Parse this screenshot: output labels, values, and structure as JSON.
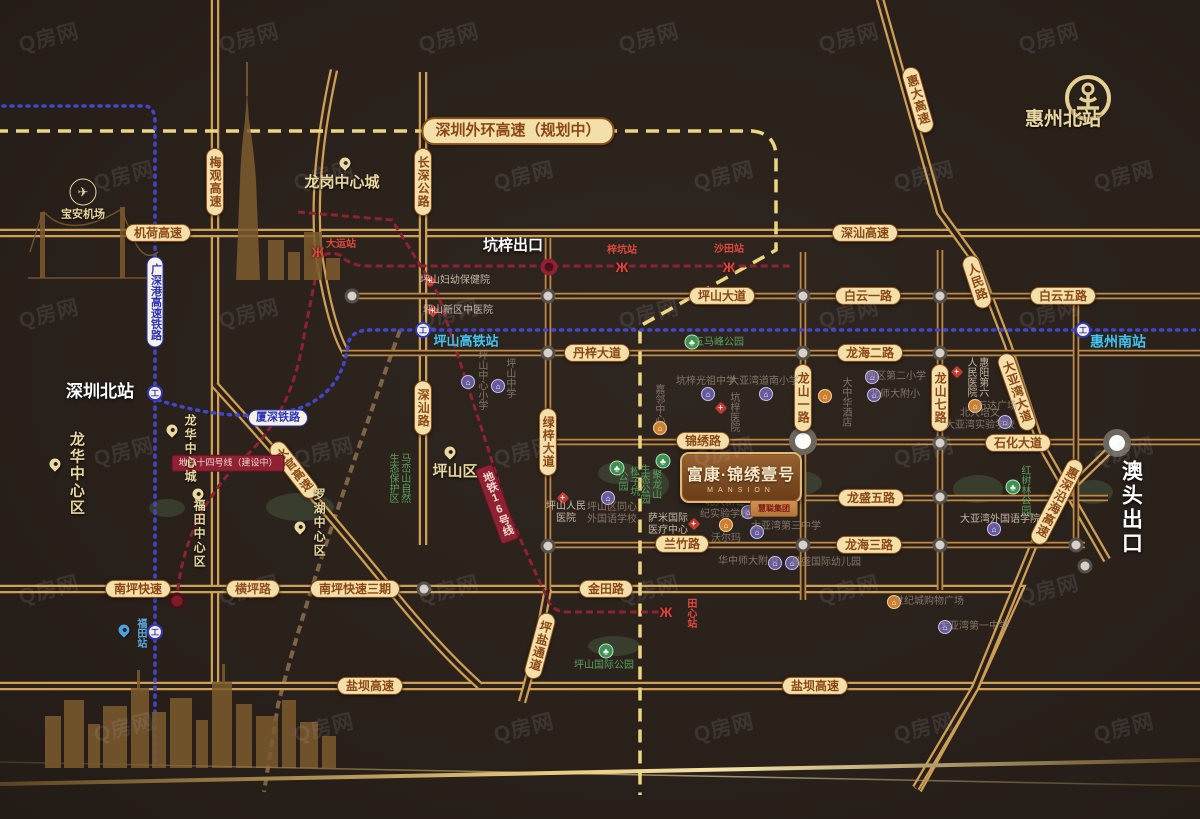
{
  "watermark": {
    "text": "Q房网"
  },
  "project": {
    "name": "富康·锦绣壹号",
    "subtitle": "MANSION",
    "badge": "慧聪集团"
  },
  "colors": {
    "road": "#c08a44",
    "highway": "#cf9f55",
    "planned_dash": "#ecd77f",
    "metro_dash": "#8e2132",
    "rail_dotted": "#4146cc",
    "pill_bg": "#f3dfa9",
    "pill_text": "#8a4715",
    "cyan": "#41c6f3",
    "khaki": "#ead8a0",
    "station_red": "#e0483c",
    "park_green": "#5aa35f",
    "gold": "#e7c87a"
  },
  "map": {
    "texts": [
      {
        "s": "深圳外环高速（规划中）",
        "c": "pill big",
        "x": 518,
        "y": 131,
        "n": "road-label-shenzhen-outer-ring"
      },
      {
        "s": "机荷高速",
        "c": "pill",
        "x": 158,
        "y": 233,
        "n": "road-label-jihe"
      },
      {
        "s": "深汕高速",
        "c": "pill",
        "x": 865,
        "y": 233,
        "n": "road-label-shenshan-expwy"
      },
      {
        "s": "坪山大道",
        "c": "pill",
        "x": 722,
        "y": 296,
        "n": "road-label-pingshan-ave"
      },
      {
        "s": "白云一路",
        "c": "pill",
        "x": 868,
        "y": 296,
        "n": "road-label-baiyun-1"
      },
      {
        "s": "白云五路",
        "c": "pill",
        "x": 1063,
        "y": 296,
        "n": "road-label-baiyun-5"
      },
      {
        "s": "丹梓大道",
        "c": "pill",
        "x": 597,
        "y": 353,
        "n": "road-label-danzi"
      },
      {
        "s": "龙海二路",
        "c": "pill",
        "x": 870,
        "y": 353,
        "n": "road-label-longhai-2"
      },
      {
        "s": "锦绣路",
        "c": "pill",
        "x": 703,
        "y": 441,
        "n": "road-label-jinxiu"
      },
      {
        "s": "石化大道",
        "c": "pill",
        "x": 1018,
        "y": 443,
        "n": "road-label-shihua"
      },
      {
        "s": "龙盛五路",
        "c": "pill",
        "x": 871,
        "y": 498,
        "n": "road-label-longsheng-5"
      },
      {
        "s": "兰竹路",
        "c": "pill",
        "x": 682,
        "y": 544,
        "n": "road-label-lanzhu"
      },
      {
        "s": "龙海三路",
        "c": "pill",
        "x": 869,
        "y": 545,
        "n": "road-label-longhai-3"
      },
      {
        "s": "南坪快速",
        "c": "pill",
        "x": 138,
        "y": 589,
        "n": "road-label-nanping"
      },
      {
        "s": "横坪路",
        "c": "pill",
        "x": 253,
        "y": 589,
        "n": "road-label-hengping"
      },
      {
        "s": "南坪快速三期",
        "c": "pill",
        "x": 355,
        "y": 589,
        "n": "road-label-nanping-3"
      },
      {
        "s": "金田路",
        "c": "pill",
        "x": 606,
        "y": 589,
        "n": "road-label-jintian"
      },
      {
        "s": "盐坝高速",
        "c": "pill",
        "x": 370,
        "y": 686,
        "n": "road-label-yanba-w"
      },
      {
        "s": "盐坝高速",
        "c": "pill",
        "x": 815,
        "y": 686,
        "n": "road-label-yanba-e"
      },
      {
        "s": "长深公路",
        "c": "pill",
        "v": 1,
        "x": 423,
        "y": 182,
        "n": "road-label-changshen"
      },
      {
        "s": "梅观高速",
        "c": "pill",
        "v": 1,
        "x": 215,
        "y": 182,
        "n": "road-label-meiguan"
      },
      {
        "s": "深汕路",
        "c": "pill",
        "v": 1,
        "x": 423,
        "y": 408,
        "n": "road-label-shenshan-rd"
      },
      {
        "s": "绿梓大道",
        "c": "pill",
        "v": 1,
        "x": 548,
        "y": 442,
        "n": "road-label-lvzi"
      },
      {
        "s": "龙山一路",
        "c": "pill",
        "v": 1,
        "x": 803,
        "y": 398,
        "n": "road-label-longshan-1"
      },
      {
        "s": "龙山七路",
        "c": "pill",
        "v": 1,
        "x": 940,
        "y": 398,
        "n": "road-label-longshan-7"
      },
      {
        "s": "水官高速",
        "c": "pill",
        "v": 1,
        "r": -38,
        "x": 294,
        "y": 470,
        "n": "road-label-shuiguan"
      },
      {
        "s": "惠大高速",
        "c": "pill",
        "v": 1,
        "r": -16,
        "x": 918,
        "y": 100,
        "n": "road-label-huida"
      },
      {
        "s": "人民路",
        "c": "pill",
        "v": 1,
        "r": -18,
        "x": 977,
        "y": 282,
        "n": "road-label-renmin"
      },
      {
        "s": "大亚湾大道",
        "c": "pill",
        "v": 1,
        "r": -19,
        "x": 1017,
        "y": 392,
        "n": "road-label-dayawan-ave"
      },
      {
        "s": "惠深沿海高速",
        "c": "pill",
        "v": 1,
        "r": 27,
        "x": 1057,
        "y": 502,
        "n": "road-label-huishen-coastal"
      },
      {
        "s": "坪盐通道",
        "c": "pill",
        "v": 1,
        "r": 15,
        "x": 540,
        "y": 646,
        "n": "road-label-pingyan"
      },
      {
        "s": "广深港高速铁路",
        "c": "railpill",
        "v": 1,
        "x": 155,
        "y": 302,
        "n": "rail-label-guangshengang"
      },
      {
        "s": "厦深铁路",
        "c": "railpill",
        "x": 278,
        "y": 418,
        "n": "rail-label-xiashen"
      },
      {
        "s": "地铁十四号线（建设中）",
        "c": "redbox",
        "x": 228,
        "y": 463,
        "n": "metro-label-line14"
      },
      {
        "s": "地铁16号线",
        "c": "redbox",
        "v": 1,
        "r": -20,
        "x": 497,
        "y": 504,
        "n": "metro-label-line16"
      },
      {
        "s": "深圳北站",
        "c": "white",
        "fs": 17,
        "x": 100,
        "y": 392,
        "n": "station-label-shenzhen-north"
      },
      {
        "s": "坑梓出口",
        "c": "white",
        "x": 513,
        "y": 246,
        "n": "exit-label-kengzi"
      },
      {
        "s": "澳头出口",
        "c": "white",
        "v": 1,
        "fs": 21,
        "x": 1130,
        "y": 508,
        "n": "exit-label-aotou"
      },
      {
        "s": "惠州北站",
        "c": "khaki",
        "fs": 19,
        "x": 1063,
        "y": 120,
        "n": "station-label-huizhou-north"
      },
      {
        "s": "惠州南站",
        "c": "cyan",
        "fs": 14,
        "x": 1118,
        "y": 342,
        "n": "station-label-huizhou-south"
      },
      {
        "s": "坪山高铁站",
        "c": "cyan",
        "x": 466,
        "y": 341,
        "n": "station-label-pingshan-hsr"
      },
      {
        "s": "龙岗中心城",
        "c": "khaki",
        "fs": 15,
        "x": 342,
        "y": 183,
        "n": "area-label-longgang"
      },
      {
        "s": "宝安机场",
        "c": "khaki",
        "fs": 11,
        "x": 83,
        "y": 215,
        "n": "area-label-baoan-airport"
      },
      {
        "s": "坪山区",
        "c": "khaki",
        "fs": 15,
        "x": 455,
        "y": 472,
        "n": "area-label-pingshan"
      },
      {
        "s": "龙华中心区",
        "c": "khaki",
        "v": 1,
        "fs": 15,
        "x": 76,
        "y": 474,
        "n": "area-label-longhua-district"
      },
      {
        "s": "龙华中心城",
        "c": "khaki",
        "v": 1,
        "fs": 12,
        "x": 190,
        "y": 449,
        "n": "area-label-longhua-city"
      },
      {
        "s": "福田中心区",
        "c": "khaki",
        "v": 1,
        "fs": 12,
        "x": 199,
        "y": 534,
        "n": "area-label-futian"
      },
      {
        "s": "罗湖中心区",
        "c": "khaki",
        "v": 1,
        "fs": 12,
        "x": 319,
        "y": 523,
        "n": "area-label-luohu"
      },
      {
        "s": "大运站",
        "c": "sta",
        "x": 341,
        "y": 245,
        "n": "metro-station-dayun"
      },
      {
        "s": "梓坑站",
        "c": "sta",
        "x": 622,
        "y": 251,
        "n": "metro-station-zikeng"
      },
      {
        "s": "沙田站",
        "c": "sta",
        "x": 729,
        "y": 250,
        "n": "metro-station-shatian"
      },
      {
        "s": "田心站",
        "c": "sta",
        "v": 1,
        "x": 690,
        "y": 613,
        "n": "metro-station-tianxin"
      },
      {
        "s": "福田站",
        "c": "bluesta",
        "v": 1,
        "x": 140,
        "y": 633,
        "n": "station-label-futian-hsr"
      },
      {
        "s": "五马峰公园",
        "c": "park",
        "x": 719,
        "y": 343,
        "n": "park-wumafeng"
      },
      {
        "s": "坪山国际公园",
        "c": "park",
        "x": 604,
        "y": 666,
        "n": "park-pingshan-intl"
      },
      {
        "ls": [
          "松子坑",
          "公园"
        ],
        "c": "park",
        "v": 1,
        "x": 627,
        "y": 481,
        "n": "park-songzikeng"
      },
      {
        "ls": [
          "聚龙山",
          "生态公园"
        ],
        "c": "park",
        "v": 1,
        "x": 649,
        "y": 484,
        "n": "park-julongshan"
      },
      {
        "s": "红树林公园",
        "c": "park",
        "v": 1,
        "x": 1024,
        "y": 490,
        "n": "park-hongshulin"
      },
      {
        "ls": [
          "马峦山自然",
          "生态保护区"
        ],
        "c": "park",
        "v": 1,
        "x": 398,
        "y": 478,
        "n": "park-maluanshan"
      },
      {
        "s": "坪山妇幼保健院",
        "c": "poi",
        "x": 455,
        "y": 281,
        "n": "poi-fuyou-hospital"
      },
      {
        "s": "坪山新区中医院",
        "c": "poi",
        "x": 458,
        "y": 311,
        "n": "poi-zhongyi-hospital"
      },
      {
        "ls": [
          "坪山人民",
          "医院"
        ],
        "c": "poi",
        "x": 566,
        "y": 513,
        "n": "poi-renmin-hospital"
      },
      {
        "ls": [
          "萨米国际",
          "医疗中心"
        ],
        "c": "poi",
        "x": 668,
        "y": 525,
        "n": "poi-sami-medical"
      },
      {
        "s": "大亚湾外国语学院",
        "c": "poi",
        "x": 1000,
        "y": 520,
        "n": "poi-dayawan-foreign-college"
      },
      {
        "ls": [
          "惠阳第六",
          "人民医院"
        ],
        "c": "poi",
        "v": 1,
        "x": 976,
        "y": 377,
        "n": "poi-huiyang-6th-hospital"
      },
      {
        "s": "坑梓医院",
        "c": "poi dim",
        "v": 1,
        "x": 733,
        "y": 412,
        "n": "poi-kengzi-hospital"
      },
      {
        "s": "大中华酒店",
        "c": "poi dim",
        "v": 1,
        "x": 845,
        "y": 402,
        "n": "poi-dazhonghua-hotel"
      },
      {
        "s": "嘉邻中心",
        "c": "poi dim",
        "v": 1,
        "x": 658,
        "y": 404,
        "n": "poi-jialin-center"
      },
      {
        "s": "坪山中心小学",
        "c": "poi dim",
        "v": 1,
        "x": 481,
        "y": 380,
        "n": "poi-pingshan-central-primary"
      },
      {
        "s": "坪山中学",
        "c": "poi dim",
        "v": 1,
        "x": 509,
        "y": 378,
        "n": "poi-pingshan-middle"
      },
      {
        "ls": [
          "坪山区同心",
          "外国语学校"
        ],
        "c": "poi dim",
        "x": 612,
        "y": 514,
        "n": "poi-tongxin-foreign-school"
      },
      {
        "s": "坑梓光祖中学",
        "c": "poi dim",
        "x": 706,
        "y": 382,
        "n": "poi-guangzu-middle"
      },
      {
        "s": "大亚湾道南小学",
        "c": "poi dim",
        "x": 764,
        "y": 382,
        "n": "poi-daonan-primary"
      },
      {
        "s": "西区第二小学",
        "c": "poi dim",
        "x": 896,
        "y": 377,
        "n": "poi-xiqu-2nd-primary"
      },
      {
        "s": "北师大附小",
        "c": "poi dim",
        "x": 895,
        "y": 395,
        "n": "poi-bnu-primary"
      },
      {
        "ls": [
          "北大新世",
          "纪实验学校"
        ],
        "c": "poi dim",
        "x": 725,
        "y": 509,
        "n": "poi-beida-xinshiji-school"
      },
      {
        "ls": [
          "北大培文",
          "大亚湾实验学校"
        ],
        "c": "poi dim",
        "x": 980,
        "y": 420,
        "n": "poi-beida-peiwen-school"
      },
      {
        "s": "沃尔玛",
        "c": "poi dim",
        "x": 726,
        "y": 539,
        "n": "poi-walmart"
      },
      {
        "s": "万达广场",
        "c": "poi dim",
        "x": 997,
        "y": 407,
        "n": "poi-wanda-plaza"
      },
      {
        "s": "世纪城购物广场",
        "c": "poi dim",
        "x": 929,
        "y": 602,
        "n": "poi-shijicheng-mall"
      },
      {
        "s": "大亚湾第三中学",
        "c": "poi dim",
        "x": 786,
        "y": 527,
        "n": "poi-dayawan-3rd-middle"
      },
      {
        "s": "华中师大附小",
        "c": "poi dim",
        "x": 748,
        "y": 562,
        "n": "poi-huazhongshida-primary"
      },
      {
        "s": "昌盛国际幼儿园",
        "c": "poi dim",
        "x": 826,
        "y": 563,
        "n": "poi-changsheng-kindergarten"
      },
      {
        "s": "大亚湾第一中学",
        "c": "poi dim",
        "x": 974,
        "y": 627,
        "n": "poi-dayawan-1st-middle"
      }
    ],
    "icons": [
      {
        "k": "rail",
        "x": 155,
        "y": 393,
        "n": "shenzhen-north-rail-icon"
      },
      {
        "k": "rail",
        "x": 155,
        "y": 632,
        "n": "futian-rail-icon"
      },
      {
        "k": "rail",
        "x": 423,
        "y": 330,
        "n": "pingshan-hsr-rail-icon"
      },
      {
        "k": "rail",
        "x": 1083,
        "y": 330,
        "n": "huizhou-south-rail-icon"
      },
      {
        "k": "plane",
        "x": 83,
        "y": 192,
        "n": "airport-icon"
      },
      {
        "k": "pin",
        "x": 345,
        "y": 163,
        "n": "longgang-pin-icon"
      },
      {
        "k": "pin",
        "x": 55,
        "y": 464,
        "n": "longhua-district-pin-icon"
      },
      {
        "k": "pin",
        "x": 172,
        "y": 430,
        "n": "longhua-city-pin-icon"
      },
      {
        "k": "pin",
        "x": 198,
        "y": 494,
        "n": "futian-pin-icon"
      },
      {
        "k": "pin",
        "x": 300,
        "y": 527,
        "n": "luohu-pin-icon"
      },
      {
        "k": "pin",
        "x": 450,
        "y": 452,
        "n": "pingshan-pin-icon"
      },
      {
        "k": "pinblue",
        "x": 124,
        "y": 630,
        "n": "futian-station-pin-icon"
      },
      {
        "k": "metro",
        "x": 318,
        "y": 252,
        "n": "dayun-metro-icon"
      },
      {
        "k": "metro",
        "x": 622,
        "y": 267,
        "n": "zikeng-metro-icon"
      },
      {
        "k": "metro",
        "x": 729,
        "y": 267,
        "n": "shatian-metro-icon"
      },
      {
        "k": "metro",
        "x": 666,
        "y": 612,
        "n": "tianxin-metro-icon"
      },
      {
        "k": "exit",
        "x": 549,
        "y": 267,
        "n": "kengzi-exit-icon"
      },
      {
        "k": "sta14",
        "x": 177,
        "y": 601,
        "n": "line14-station-icon"
      },
      {
        "k": "hospital",
        "x": 430,
        "y": 281,
        "n": "hospital-icon"
      },
      {
        "k": "hospital",
        "x": 433,
        "y": 311,
        "n": "hospital-icon"
      },
      {
        "k": "hospital",
        "x": 563,
        "y": 498,
        "n": "hospital-icon"
      },
      {
        "k": "hospital",
        "x": 721,
        "y": 408,
        "n": "hospital-icon"
      },
      {
        "k": "hospital",
        "x": 694,
        "y": 524,
        "n": "hospital-icon"
      },
      {
        "k": "hospital",
        "x": 957,
        "y": 372,
        "n": "hospital-icon"
      },
      {
        "k": "school",
        "x": 468,
        "y": 382,
        "n": "school-icon"
      },
      {
        "k": "school",
        "x": 498,
        "y": 386,
        "n": "school-icon"
      },
      {
        "k": "school",
        "x": 608,
        "y": 498,
        "n": "school-icon"
      },
      {
        "k": "school",
        "x": 708,
        "y": 394,
        "n": "school-icon"
      },
      {
        "k": "school",
        "x": 766,
        "y": 394,
        "n": "school-icon"
      },
      {
        "k": "school",
        "x": 872,
        "y": 377,
        "n": "school-icon"
      },
      {
        "k": "school",
        "x": 874,
        "y": 395,
        "n": "school-icon"
      },
      {
        "k": "school",
        "x": 748,
        "y": 512,
        "n": "school-icon"
      },
      {
        "k": "school",
        "x": 757,
        "y": 532,
        "n": "school-icon"
      },
      {
        "k": "school",
        "x": 775,
        "y": 563,
        "n": "school-icon"
      },
      {
        "k": "school",
        "x": 792,
        "y": 563,
        "n": "school-icon"
      },
      {
        "k": "school",
        "x": 945,
        "y": 627,
        "n": "school-icon"
      },
      {
        "k": "school",
        "x": 994,
        "y": 529,
        "n": "school-icon"
      },
      {
        "k": "school",
        "x": 1005,
        "y": 422,
        "n": "school-icon"
      },
      {
        "k": "mall",
        "x": 726,
        "y": 525,
        "n": "mall-icon"
      },
      {
        "k": "mall",
        "x": 975,
        "y": 406,
        "n": "mall-icon"
      },
      {
        "k": "mall",
        "x": 894,
        "y": 602,
        "n": "mall-icon"
      },
      {
        "k": "mall",
        "x": 660,
        "y": 428,
        "n": "mall-icon"
      },
      {
        "k": "hotel",
        "x": 825,
        "y": 396,
        "n": "hotel-icon"
      },
      {
        "k": "park",
        "x": 692,
        "y": 342,
        "n": "park-icon"
      },
      {
        "k": "park",
        "x": 617,
        "y": 468,
        "n": "park-icon"
      },
      {
        "k": "park",
        "x": 663,
        "y": 461,
        "n": "park-icon"
      },
      {
        "k": "park",
        "x": 606,
        "y": 651,
        "n": "park-icon"
      },
      {
        "k": "park",
        "x": 1013,
        "y": 487,
        "n": "park-icon"
      },
      {
        "k": "dot",
        "x": 352,
        "y": 296,
        "n": "junction-dot"
      },
      {
        "k": "dot",
        "x": 548,
        "y": 296,
        "n": "junction-dot"
      },
      {
        "k": "dot",
        "x": 548,
        "y": 353,
        "n": "junction-dot"
      },
      {
        "k": "dot",
        "x": 548,
        "y": 443,
        "n": "junction-dot"
      },
      {
        "k": "dot",
        "x": 548,
        "y": 546,
        "n": "junction-dot"
      },
      {
        "k": "dot",
        "x": 424,
        "y": 589,
        "n": "junction-dot"
      },
      {
        "k": "dot",
        "x": 803,
        "y": 296,
        "n": "junction-dot"
      },
      {
        "k": "dot",
        "x": 803,
        "y": 353,
        "n": "junction-dot"
      },
      {
        "k": "dot",
        "x": 803,
        "y": 545,
        "n": "junction-dot"
      },
      {
        "k": "dot",
        "x": 940,
        "y": 296,
        "n": "junction-dot"
      },
      {
        "k": "dot",
        "x": 940,
        "y": 353,
        "n": "junction-dot"
      },
      {
        "k": "dot",
        "x": 940,
        "y": 443,
        "n": "junction-dot"
      },
      {
        "k": "dot",
        "x": 940,
        "y": 497,
        "n": "junction-dot"
      },
      {
        "k": "dot",
        "x": 940,
        "y": 545,
        "n": "junction-dot"
      },
      {
        "k": "dot",
        "x": 1076,
        "y": 296,
        "n": "junction-dot"
      },
      {
        "k": "dot",
        "x": 1076,
        "y": 545,
        "n": "junction-dot"
      },
      {
        "k": "dot",
        "x": 1085,
        "y": 566,
        "n": "junction-dot"
      },
      {
        "k": "big",
        "x": 803,
        "y": 441,
        "n": "major-junction-dot"
      },
      {
        "k": "big",
        "x": 1117,
        "y": 443,
        "n": "major-junction-dot"
      }
    ]
  }
}
